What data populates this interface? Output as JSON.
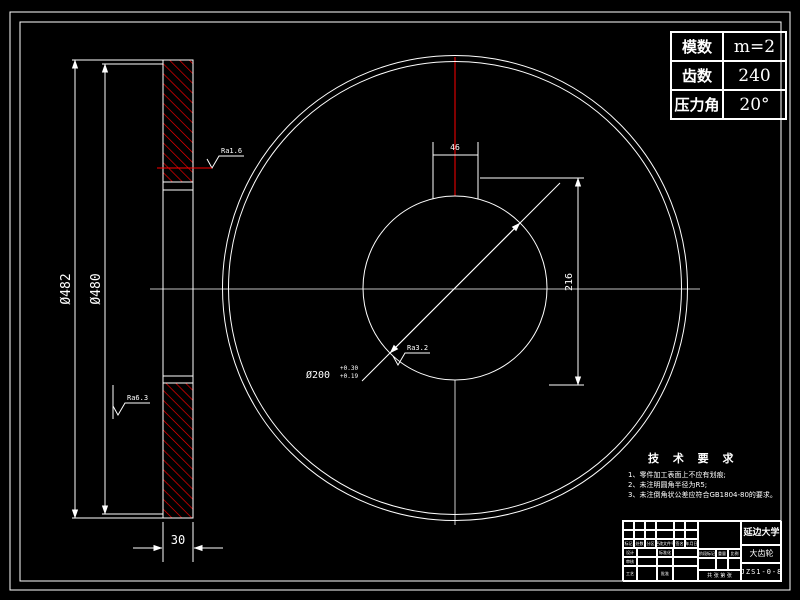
{
  "colors": {
    "background": "#000000",
    "line": "#ffffff",
    "hatch_red": "#ff0000"
  },
  "param_table": {
    "rows": [
      {
        "label": "模数",
        "value": "m=2"
      },
      {
        "label": "齿数",
        "value": "240"
      },
      {
        "label": "压力角",
        "value": "20°"
      }
    ]
  },
  "dimensions": {
    "outer_diameter": "Ø482",
    "pitch_diameter": "Ø480",
    "thickness": "30",
    "keyway_width": "46",
    "keyway_height": "216",
    "bore_diameter": "Ø200",
    "bore_tol_upper": "+0.30",
    "bore_tol_lower": "+0.19"
  },
  "roughness": {
    "rim": "Ra1.6",
    "web": "Ra6.3",
    "bore": "Ra3.2"
  },
  "tech_requirements": {
    "title": "技 术 要 求",
    "lines": [
      "1、零件加工表面上不应有划痕;",
      "2、未注明圆角半径为R5;",
      "3、未注倒角状公差应符合GB1804-80的要求。"
    ]
  },
  "title_block": {
    "company": "延边大学",
    "part_name": "大齿轮",
    "drawing_number": "JZS1-0-8",
    "header_row": [
      "标记",
      "处数",
      "分区",
      "更改文件号",
      "签名",
      "年月日"
    ],
    "roles": {
      "design": "设计",
      "review": "审核",
      "process": "工艺",
      "approve": "批准",
      "standardize": "标准化"
    },
    "fields": {
      "stage": "阶段标记",
      "weight": "重量",
      "scale": "比例",
      "sheet": "共 张 第 张"
    }
  }
}
